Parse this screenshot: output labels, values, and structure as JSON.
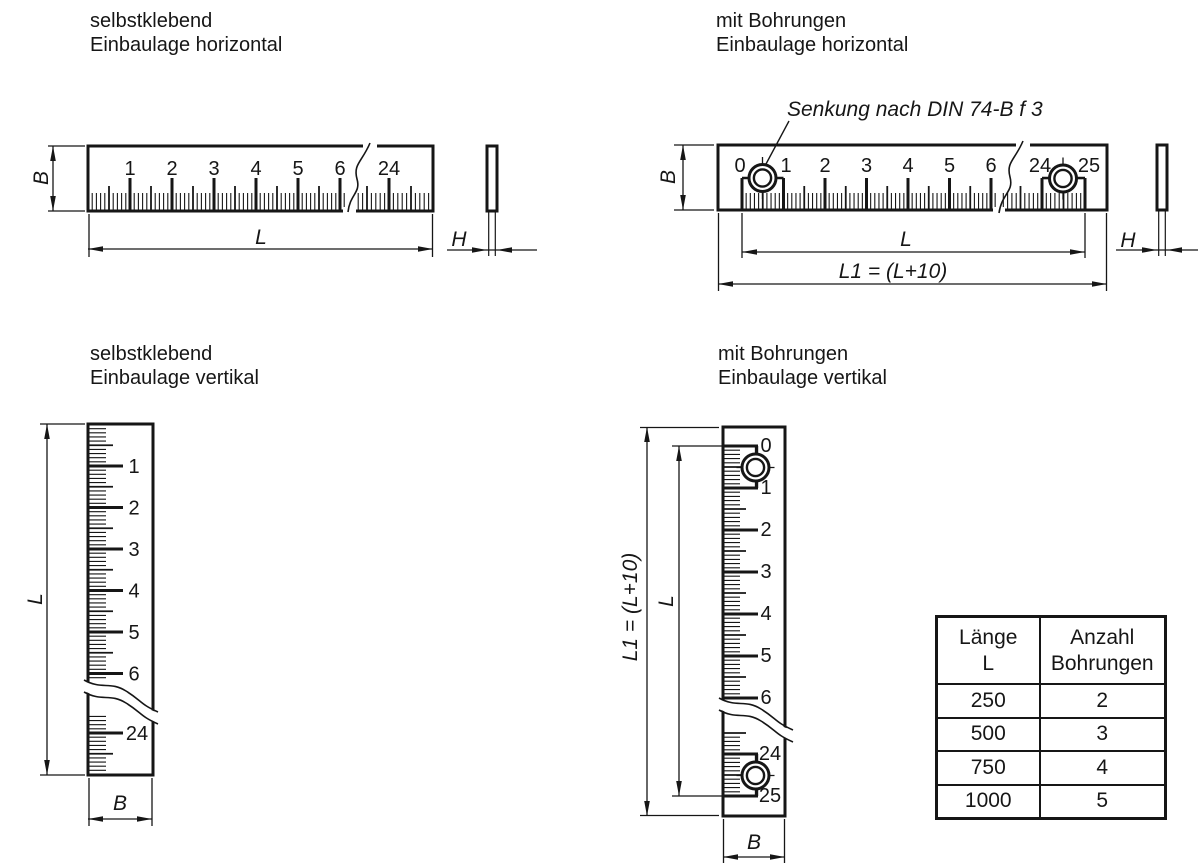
{
  "sections": {
    "top_left": {
      "title_line1": "selbstklebend",
      "title_line2": "Einbaulage horizontal"
    },
    "top_right": {
      "title_line1": "mit Bohrungen",
      "title_line2": "Einbaulage horizontal",
      "annotation": "Senkung nach DIN 74-B f 3"
    },
    "bottom_left": {
      "title_line1": "selbstklebend",
      "title_line2": "Einbaulage vertikal"
    },
    "bottom_right": {
      "title_line1": "mit Bohrungen",
      "title_line2": "Einbaulage vertikal"
    }
  },
  "dimension_labels": {
    "width": "B",
    "length": "L",
    "thickness": "H",
    "total_length": "L1 = (L+10)"
  },
  "scales": {
    "adhesive_labels": [
      "1",
      "2",
      "3",
      "4",
      "5",
      "6",
      "24"
    ],
    "drilled_labels": [
      "0",
      "1",
      "2",
      "3",
      "4",
      "5",
      "6",
      "24",
      "25"
    ]
  },
  "table": {
    "headers": [
      [
        "Länge",
        "L"
      ],
      [
        "Anzahl",
        "Bohrungen"
      ]
    ],
    "rows": [
      [
        "250",
        "2"
      ],
      [
        "500",
        "3"
      ],
      [
        "750",
        "4"
      ],
      [
        "1000",
        "5"
      ]
    ]
  },
  "colors": {
    "line": "#161616",
    "background": "#ffffff"
  }
}
